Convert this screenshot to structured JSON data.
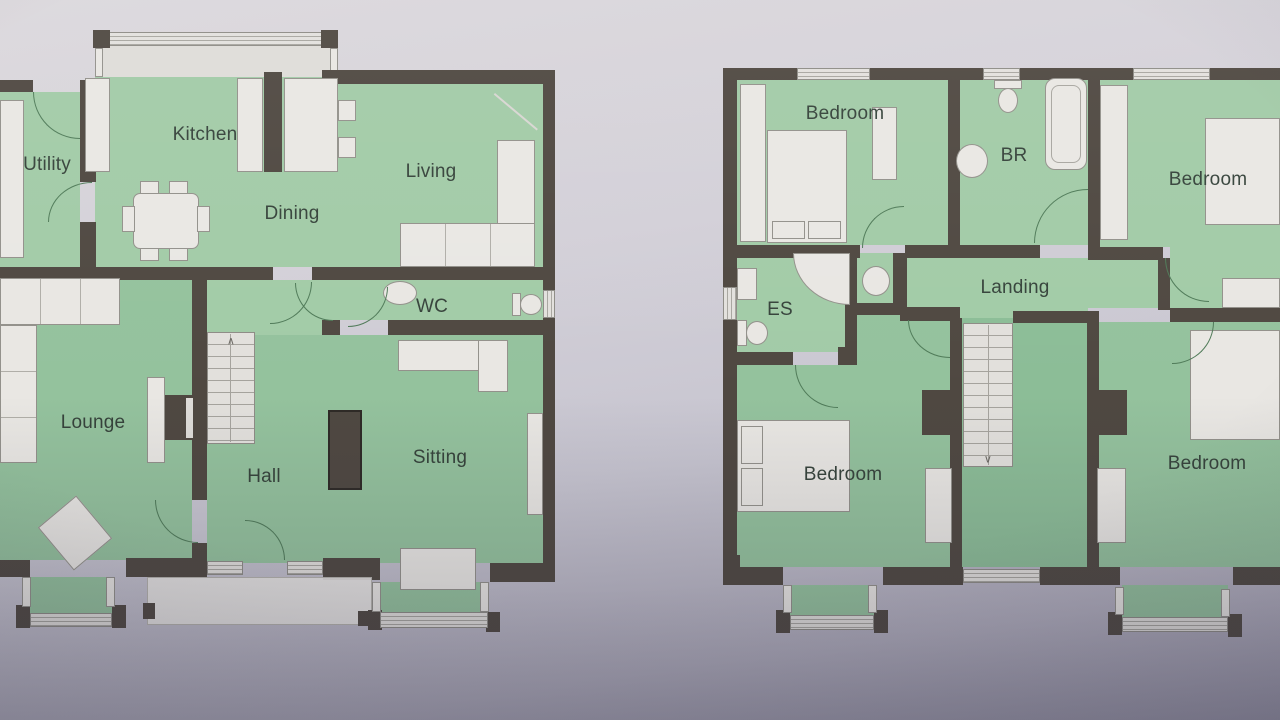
{
  "colors": {
    "room_fill": "#a2cba7",
    "wall": "#4f4841",
    "furniture": "#e9e7e3",
    "paper": "#cdcad4",
    "label_text": "#36433b"
  },
  "ground_floor": {
    "rooms": {
      "utility": "Utility",
      "kitchen": "Kitchen",
      "dining": "Dining",
      "living": "Living",
      "wc": "WC",
      "lounge": "Lounge",
      "hall": "Hall",
      "sitting": "Sitting"
    },
    "stairs_arrow": "∧"
  },
  "first_floor": {
    "rooms": {
      "bedroom_top_left": "Bedroom",
      "bathroom": "BR",
      "bedroom_top_right": "Bedroom",
      "ensuite": "ES",
      "landing": "Landing",
      "bedroom_bottom_left": "Bedroom",
      "bedroom_bottom_right": "Bedroom"
    },
    "stairs_arrow": "∨"
  }
}
